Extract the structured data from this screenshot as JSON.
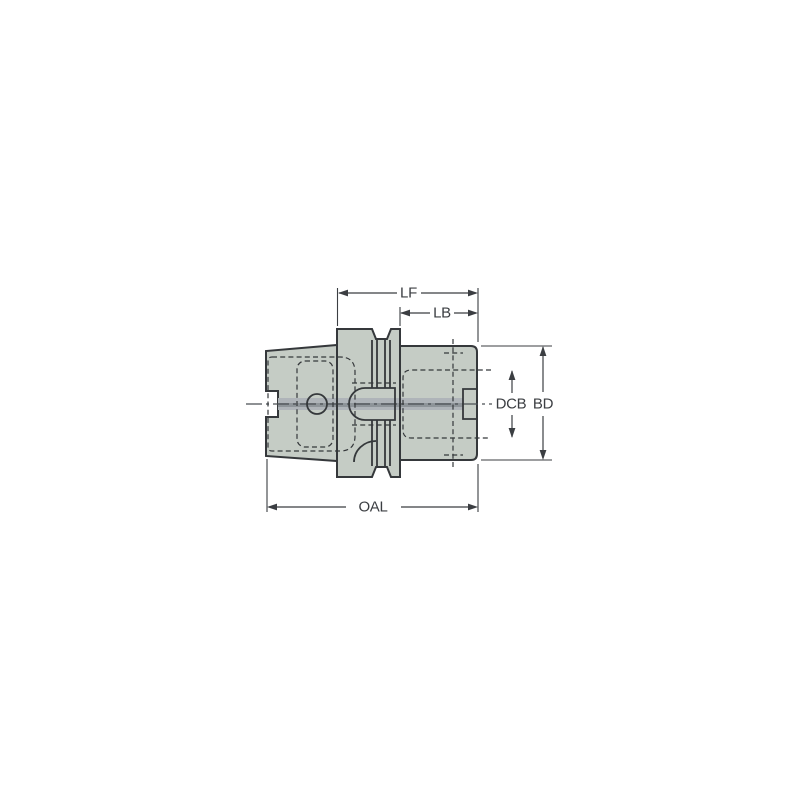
{
  "drawing": {
    "type": "technical-drawing",
    "description": "Side-view engineering drawing of a cylindrical tool holder with tapered shank, grooved flange and clamping body, annotated with dimension callouts",
    "labels": {
      "lf": "LF",
      "lb": "LB",
      "dcb": "DCB",
      "bd": "BD",
      "oal": "OAL"
    },
    "colors": {
      "background": "#ffffff",
      "body_fill": "#c5ccc5",
      "outline": "#35383b",
      "bore_band": "#afb4b9",
      "bore_core": "#8e9499",
      "centerline": "#4b4f54",
      "dimension_line": "#3b3e42",
      "label_text": "#3b3e42"
    }
  }
}
